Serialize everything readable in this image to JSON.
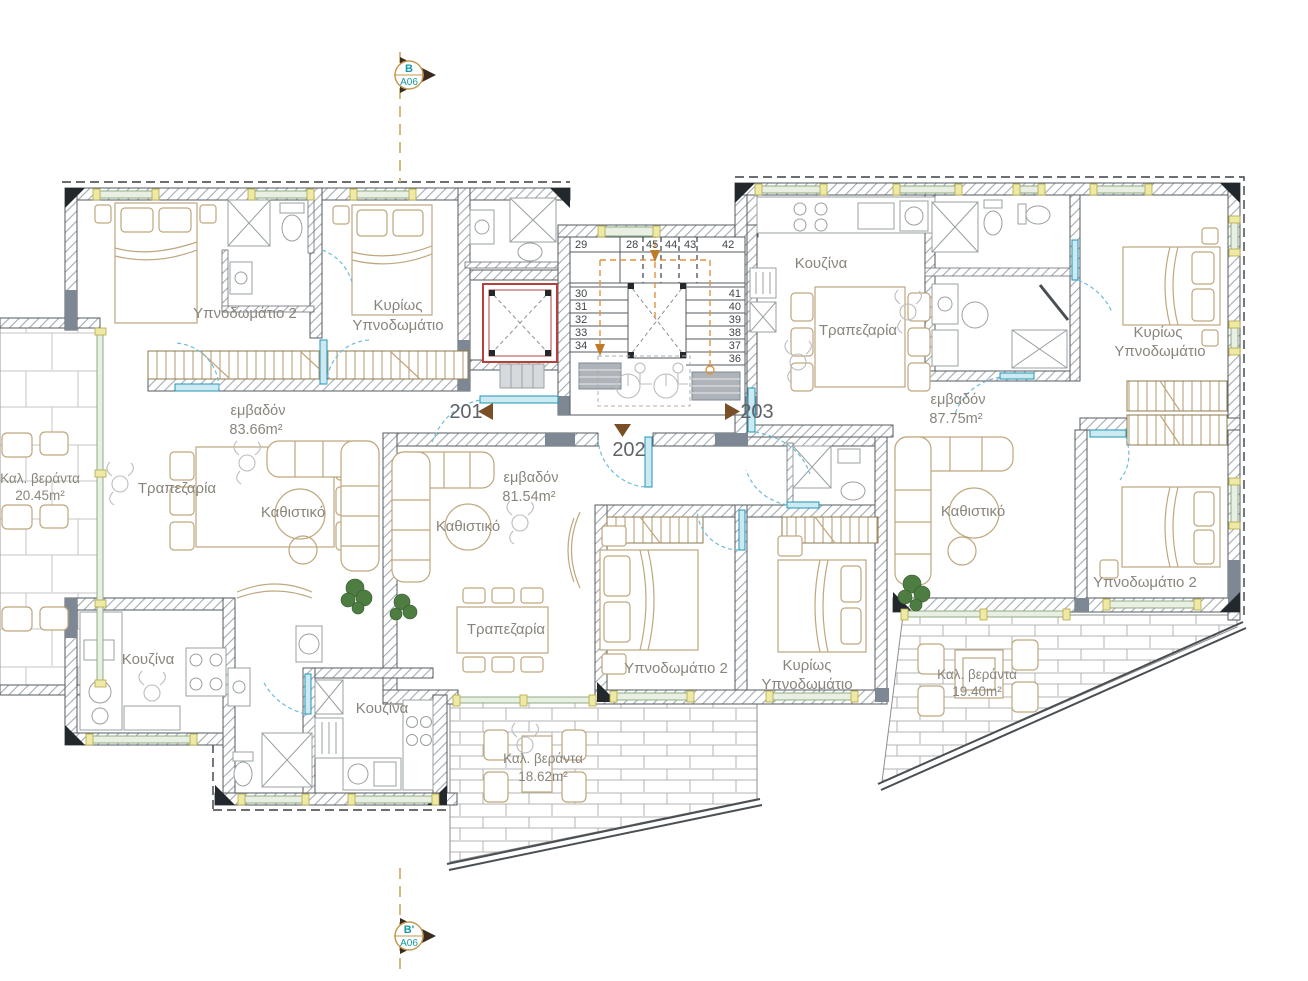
{
  "section_markers": {
    "top": {
      "code": "B",
      "sheet": "A06"
    },
    "bottom": {
      "code": "B'",
      "sheet": "A06"
    }
  },
  "units": {
    "u201": {
      "number": "201",
      "area_word": "εμβαδόν",
      "area": "83.66m²"
    },
    "u202": {
      "number": "202",
      "area_word": "εμβαδόν",
      "area": "81.54m²"
    },
    "u203": {
      "number": "203",
      "area_word": "εμβαδόν",
      "area": "87.75m²"
    }
  },
  "room_names": {
    "bedroom2": "Υπνοδωμάτιο 2",
    "master1": "Κυρίως",
    "master2": "Υπνοδωμάτιο",
    "living": "Καθιστικό",
    "dining": "Τραπεζαρία",
    "kitchen": "Κουζίνα",
    "veranda": "Καλ. βεράντα"
  },
  "verandas": {
    "left": "20.45m²",
    "middle": "18.62m²",
    "right": "19.40m²"
  },
  "stairs": {
    "top_row": [
      "29",
      "28",
      "45",
      "44",
      "43",
      "42"
    ],
    "left_flight": [
      "30",
      "31",
      "32",
      "33",
      "34"
    ],
    "right_flight": [
      "41",
      "40",
      "39",
      "38",
      "37",
      "36"
    ]
  }
}
